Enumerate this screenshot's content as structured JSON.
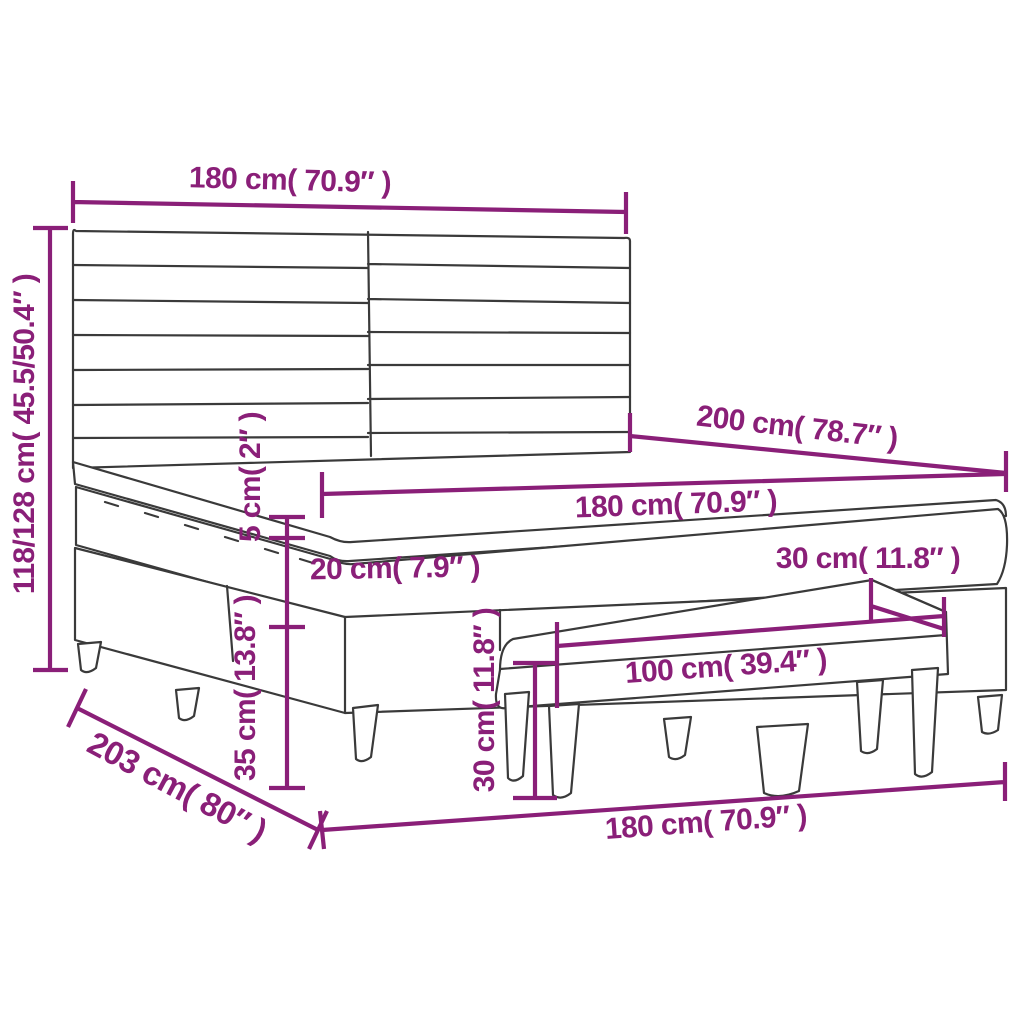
{
  "diagram": {
    "subject": "Box spring bed with slatted headboard, topper mattress and bench - dimension diagram",
    "accent_color": "#8a1f78",
    "line_color": "#3a3a3a",
    "background_color": "#ffffff"
  },
  "labels": {
    "top_width": "180 cm( 70.9″ )",
    "overall_height": "118/128 cm( 45.5/50.4″ )",
    "bed_length": "200 cm( 78.7″ )",
    "mattress_width": "180 cm( 70.9″ )",
    "topper_thickness": "5 cm( 2″ )",
    "mattress_thickness": "20 cm( 7.9″ )",
    "base_height": "35 cm( 13.8″ )",
    "floor_length": "203 cm( 80″ )",
    "bottom_width": "180 cm( 70.9″ )",
    "bench_length": "100 cm( 39.4″ )",
    "bench_depth": "30 cm( 11.8″ )",
    "bench_height": "30 cm( 11.8″ )"
  }
}
